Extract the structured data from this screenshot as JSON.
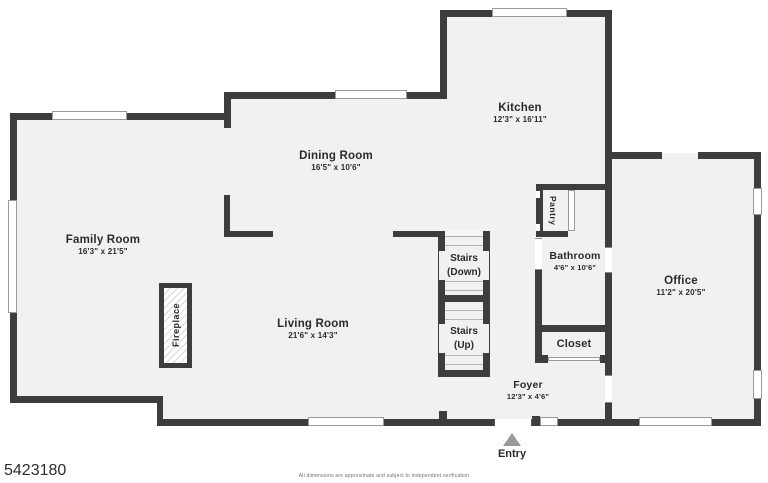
{
  "plan": {
    "rooms": {
      "kitchen": {
        "name": "Kitchen",
        "dims": "12'3\" x 16'11\""
      },
      "dining_room": {
        "name": "Dining Room",
        "dims": "16'5\" x 10'6\""
      },
      "family_room": {
        "name": "Family Room",
        "dims": "16'3\" x 21'5\""
      },
      "living_room": {
        "name": "Living Room",
        "dims": "21'6\" x 14'3\""
      },
      "office": {
        "name": "Office",
        "dims": "11'2\" x 20'5\""
      },
      "bathroom": {
        "name": "Bathroom",
        "dims": "4'6\" x 10'6\""
      },
      "foyer": {
        "name": "Foyer",
        "dims": "12'3\" x 4'6\""
      },
      "closet": {
        "name": "Closet"
      },
      "pantry": {
        "name": "Pantry"
      },
      "fireplace": {
        "name": "Fireplace"
      },
      "stairs_down": {
        "line1": "Stairs",
        "line2": "(Down)"
      },
      "stairs_up": {
        "line1": "Stairs",
        "line2": "(Up)"
      },
      "entry": {
        "name": "Entry"
      }
    },
    "colors": {
      "wall": "#3d3d3d",
      "floor": "#f1f1f2",
      "window_frame": "#9a9a9a",
      "entry_arrow": "#9a9a9a",
      "label_text": "#2b2b2b"
    }
  },
  "footer": {
    "listing_id": "5423180",
    "disclaimer": "All dimensions are approximate and subject to independent verification"
  }
}
